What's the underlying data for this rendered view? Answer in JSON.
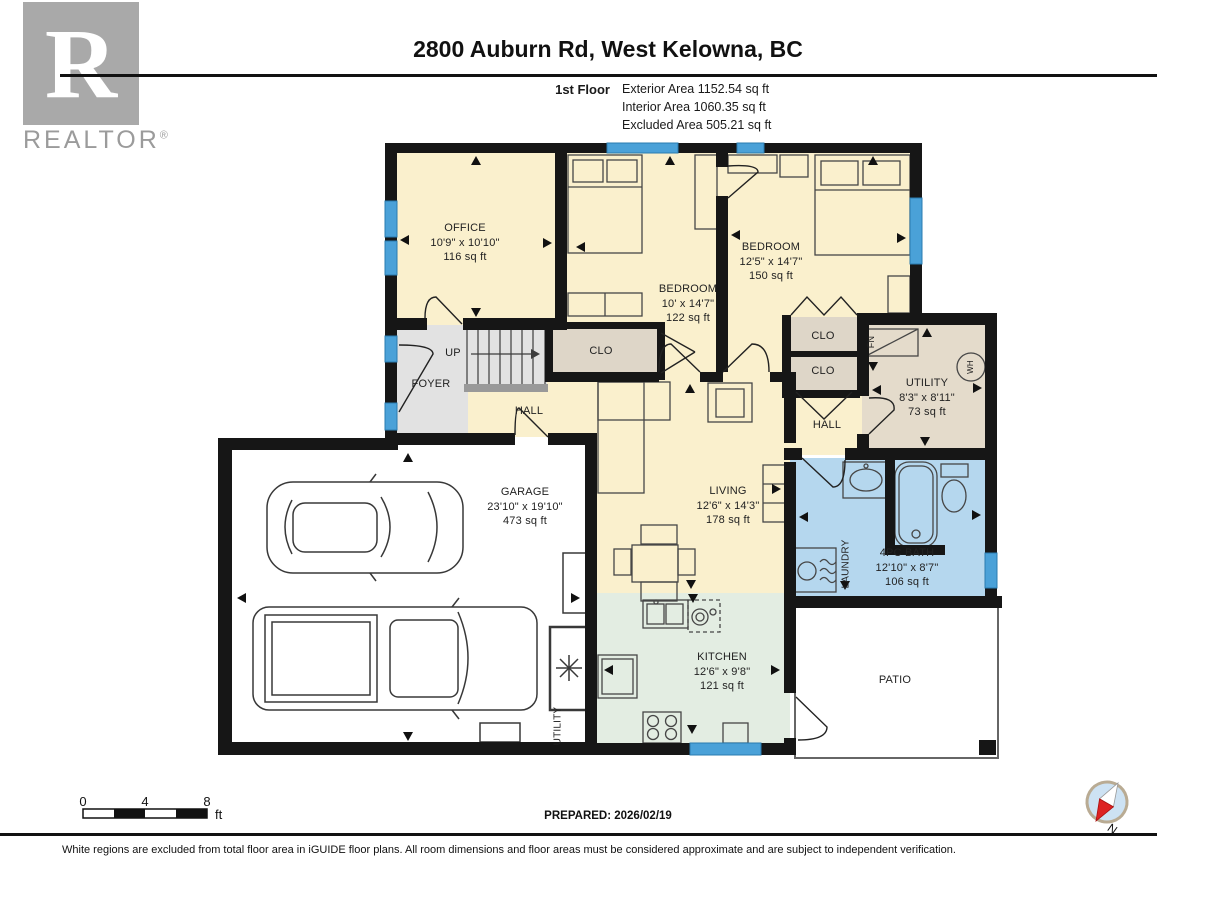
{
  "logo": {
    "letter": "R",
    "wordmark": "REALTOR",
    "reg": "®"
  },
  "header": {
    "title": "2800 Auburn Rd, West Kelowna, BC",
    "floor_label": "1st Floor",
    "stats": [
      "Exterior Area 1152.54 sq ft",
      "Interior Area 1060.35 sq ft",
      "Excluded Area 505.21 sq ft"
    ]
  },
  "plan": {
    "rooms": [
      {
        "name": "OFFICE",
        "dims": "10'9\" x 10'10\"",
        "area": "116 sq ft"
      },
      {
        "name": "BEDROOM",
        "dims": "10' x 14'7\"",
        "area": "122 sq ft"
      },
      {
        "name": "BEDROOM",
        "dims": "12'5\" x 14'7\"",
        "area": "150 sq ft"
      },
      {
        "name": "UTILITY",
        "dims": "8'3\" x 8'11\"",
        "area": "73 sq ft"
      },
      {
        "name": "GARAGE",
        "dims": "23'10\" x 19'10\"",
        "area": "473 sq ft"
      },
      {
        "name": "LIVING",
        "dims": "12'6\" x 14'3\"",
        "area": "178 sq ft"
      },
      {
        "name": "KITCHEN",
        "dims": "12'6\" x 9'8\"",
        "area": "121 sq ft"
      },
      {
        "name": "4PC BATH",
        "dims": "12'10\" x 8'7\"",
        "area": "106 sq ft"
      }
    ],
    "labels": {
      "foyer": "FOYER",
      "up": "UP",
      "hall_left": "HALL",
      "clo_mid": "CLO",
      "clo_top": "CLO",
      "clo_bottom": "CLO",
      "hall_right": "HALL",
      "laundry": "LAUNDRY",
      "utility_garage": "UTILITY",
      "patio": "PATIO",
      "furnace": "FN",
      "water_heater": "WH"
    },
    "colors": {
      "room_cream": "#faf0cd",
      "closet_taupe": "#ded6c8",
      "utility_tan": "#e4dbcb",
      "bath_blue": "#b5d7ee",
      "kitchen_green": "#e3ede2",
      "hall_gray": "#e2e2e2",
      "window_blue": "#4aa1d8",
      "wall_black": "#161616"
    }
  },
  "footer": {
    "scale": {
      "ticks": [
        "0",
        "4",
        "8"
      ],
      "unit": "ft"
    },
    "prepared": "PREPARED: 2026/02/19",
    "disclaimer": "White regions are excluded from total floor area in iGUIDE floor plans. All room dimensions and floor areas must be considered approximate and are subject to independent verification."
  },
  "compass": {
    "north": "N"
  }
}
